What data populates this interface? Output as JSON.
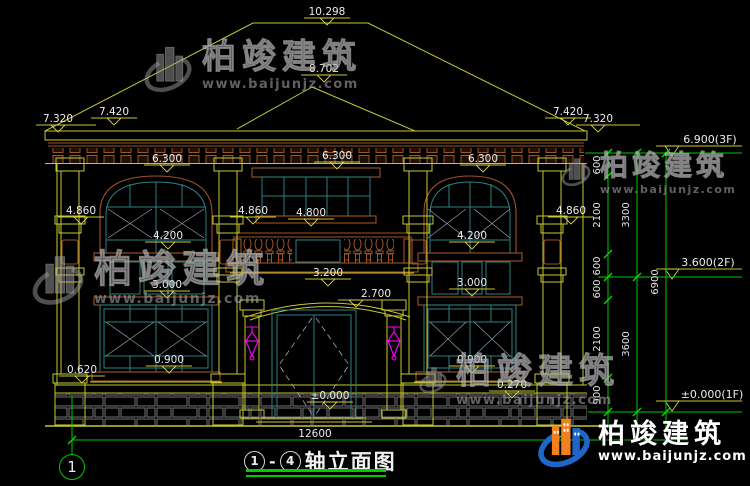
{
  "drawing": {
    "title": {
      "axis_start": "1",
      "axis_end": "4",
      "separator": "-",
      "name": "轴立面图"
    },
    "axis_bubbles": {
      "left": "1"
    },
    "elevation_labels": {
      "v10298": "10.298",
      "v8702": "8.702",
      "v7420": "7.420",
      "v7320": "7.320",
      "v6300": "6.300",
      "v4860": "4.860",
      "v4800": "4.800",
      "v4200": "4.200",
      "v3200": "3.200",
      "v3000": "3.000",
      "v2700": "2.700",
      "v0900": "0.900",
      "v0620": "0.620",
      "v0270": "0.270",
      "v0000": "±0.000"
    },
    "floor_levels": {
      "f3": "6.900(3F)",
      "f2": "3.600(2F)",
      "f1": "±0.000(1F)"
    },
    "dim_chain": {
      "c600": "600",
      "c2100": "2100",
      "c900": "900",
      "c3300": "3300",
      "c3600": "3600",
      "c6900": "6900",
      "c12600": "12600"
    }
  },
  "watermark": {
    "brand": "柏竣建筑",
    "url": "www.baijunjz.com"
  },
  "colors": {
    "background": "#000000",
    "line_yellow": "#c8c832",
    "window_teal": "#2e8080",
    "trim_brown": "#9c5526",
    "annotation_green": "#00c800",
    "lamp_magenta": "#ff00ff",
    "dim_text": "#ececec",
    "brand_blue": "#1e66c8",
    "brand_orange": "#f08020"
  }
}
